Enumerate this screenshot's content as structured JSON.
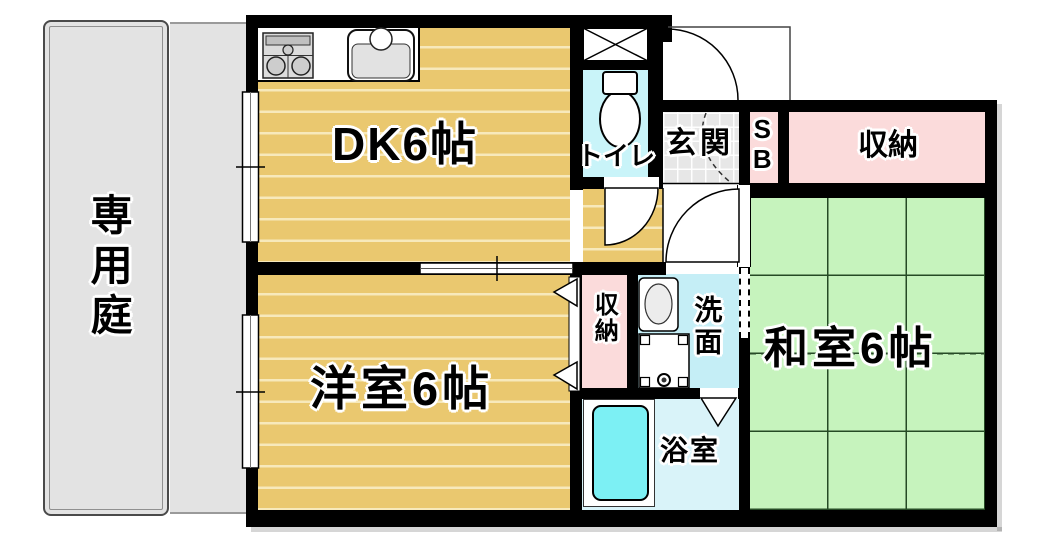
{
  "rooms": {
    "private_garden": {
      "label": "専用庭"
    },
    "dining_kitchen": {
      "label": "DK6帖"
    },
    "western_room": {
      "label": "洋室6帖"
    },
    "japanese_room": {
      "label": "和室6帖"
    },
    "toilet": {
      "label": "トイレ"
    },
    "entrance": {
      "label": "玄関"
    },
    "shoe_box": {
      "label": "SB"
    },
    "storage_hall": {
      "label": "収納"
    },
    "storage_small": {
      "label": "収納"
    },
    "washroom": {
      "label": "洗面"
    },
    "bathroom": {
      "label": "浴室"
    }
  },
  "colors": {
    "wall": "#000000",
    "wood_floor": "#eac86f",
    "wood_plank_line": "#f7e9bb",
    "tatami_green": "#c6f3bd",
    "storage_pink": "#fbdbdb",
    "water_cyan": "#c5eef6",
    "toilet_cyan": "#c9f4f9",
    "bath_floor_cyan": "#d9f3f9",
    "bathtub_cyan": "#7cf0f4",
    "garden_gray": "#e3e3e3",
    "entrance_tile_gray": "#e7e7e7"
  }
}
